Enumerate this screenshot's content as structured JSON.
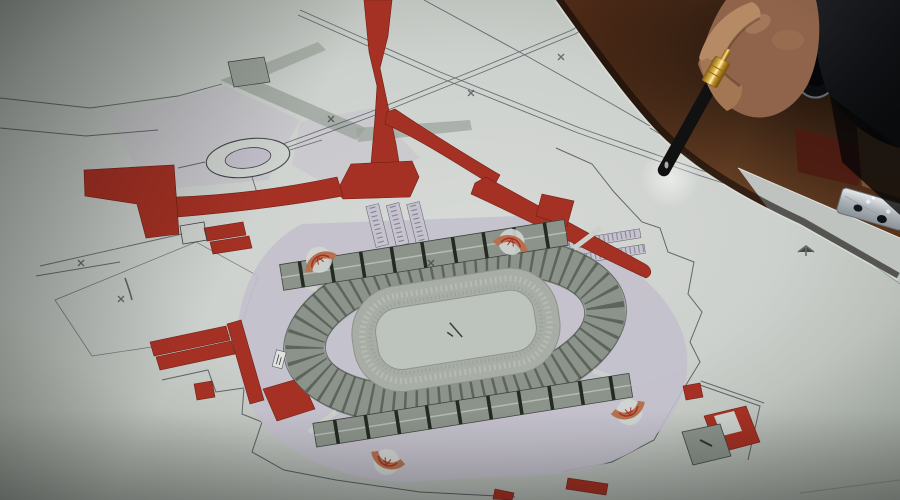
{
  "image": {
    "kind": "photograph",
    "subject": "Hand with a fountain pen pointing at an architectural site plan of a stadium laid on a wooden table"
  },
  "colors": {
    "table_wood": "#6b3a20",
    "table_wood_dark": "#241209",
    "paper_bright": "#d6d9d5",
    "paper_shade": "#99a099",
    "plan_line": "#3c4248",
    "plan_red": "#a53124",
    "plan_red_dark": "#6e1f15",
    "plan_lavender": "#c3bfcc",
    "road_grey": "#9aa29a",
    "stand_grey": "#8b938b",
    "stand_hatch": "#3e443d",
    "track_grey": "#a8aea6",
    "field_grey": "#bdc3bd",
    "fan_tan": "#b5714f",
    "skin": "#8f644a",
    "skin_light": "#b78a66",
    "sleeve_black": "#141519",
    "pen_black": "#111111",
    "pen_gold": "#e8c05a",
    "metal_silver": "#aab1b7"
  },
  "objects": {
    "pen": "black fountain pen with gold band",
    "hand": "hand gripping the pen",
    "watch": "dark round wristwatch",
    "sleeve": "dark suit sleeve",
    "plan_sheet": "large printed master-plan sheet",
    "stadium": "oval stadium with running track and stands",
    "roundabout": "traffic roundabout",
    "red_roads": "red highlighted access roads",
    "red_buildings": "red highlighted buildings",
    "table": "reddish-brown wooden table",
    "metal_strip": "metal binding strip",
    "second_sheet": "blank paper sheet under plan"
  }
}
